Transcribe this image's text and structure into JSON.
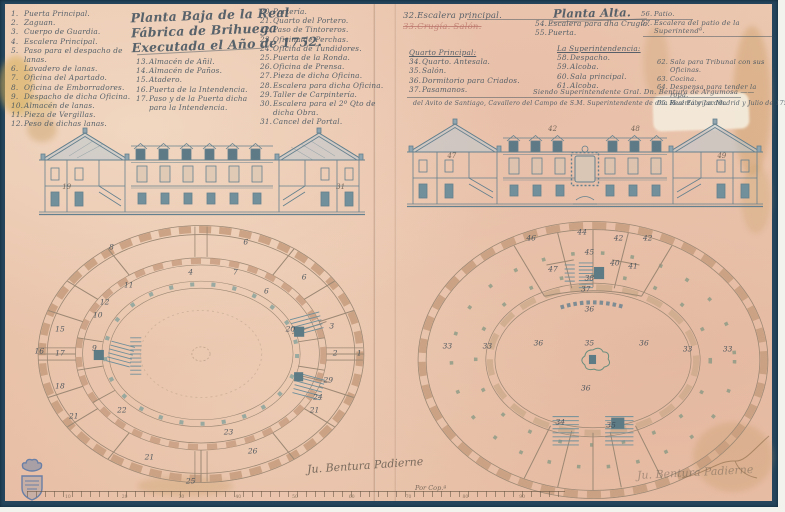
{
  "colors": {
    "paper": "#e9c4ac",
    "frame": "#24455c",
    "ink": "#42525e",
    "wall": "#c89e80",
    "stamp_blue": "#4a6fa5",
    "roof": "#9db3bd",
    "pillar_teal": "#7e9f9b"
  },
  "doc": {
    "left_title": {
      "l1": "Planta Baja de la Real",
      "l2": "Fábrica de Brihuega",
      "l3": "Executada el Año de 1752."
    },
    "right_title": "Planta Alta."
  },
  "legend_left": {
    "col1": [
      {
        "n": "1.",
        "t": "Puerta Principal."
      },
      {
        "n": "2.",
        "t": "Zaguan."
      },
      {
        "n": "3.",
        "t": "Cuerpo de Guardia."
      },
      {
        "n": "4.",
        "t": "Escalera Principal."
      },
      {
        "n": "5.",
        "t": "Paso para el despacho de lanas."
      },
      {
        "n": "6.",
        "t": "Lavadero de lanas."
      },
      {
        "n": "7.",
        "t": "Oficina del Apartado."
      },
      {
        "n": "8.",
        "t": "Oficina de Emborradores."
      },
      {
        "n": "9.",
        "t": "Despacho de dicha Oficina."
      },
      {
        "n": "10.",
        "t": "Almacén de lanas."
      },
      {
        "n": "11.",
        "t": "Pieza de Vergillas."
      },
      {
        "n": "12.",
        "t": "Peso de dichas lanas."
      }
    ],
    "col2": [
      {
        "n": "13.",
        "t": "Almacén de Añil."
      },
      {
        "n": "14.",
        "t": "Almacén de Paños."
      },
      {
        "n": "15.",
        "t": "Atadero."
      },
      {
        "n": "16.",
        "t": "Puerta de la Intendencia."
      },
      {
        "n": "17.",
        "t": "Paso y de la Puerta dicha"
      },
      {
        "n": "",
        "t": "para la Intendencia."
      }
    ],
    "col3": [
      {
        "n": "20.",
        "t": "Portería."
      },
      {
        "n": "21.",
        "t": "Quarto del Portero."
      },
      {
        "n": "22.",
        "t": "Paso de Tintoreros."
      },
      {
        "n": "23.",
        "t": "Oficina de Perchas."
      },
      {
        "n": "24.",
        "t": "Oficina de Tundidores."
      },
      {
        "n": "25.",
        "t": "Puerta de la Ronda."
      },
      {
        "n": "26.",
        "t": "Oficina de Prensa."
      },
      {
        "n": "27.",
        "t": "Pieza de dicha Oficina."
      },
      {
        "n": "28.",
        "t": "Escalera para dicha Oficina."
      },
      {
        "n": "29.",
        "t": "Taller de Carpintería."
      },
      {
        "n": "30.",
        "t": "Escalera para el 2º Qto de dicha Obra."
      },
      {
        "n": "31.",
        "t": "Cancel del Portal."
      }
    ]
  },
  "legend_right": {
    "a1": {
      "n": "32.",
      "t": "Escalera principal."
    },
    "a2": {
      "n": "33.",
      "t": "Crugía. Salón."
    },
    "quarto_header": "Quarto Principal:",
    "quarto": [
      {
        "n": "34.",
        "t": "Quarto. Antesala."
      },
      {
        "n": "35.",
        "t": "Salón."
      },
      {
        "n": "36.",
        "t": "Dormitorio para Criados."
      },
      {
        "n": "37.",
        "t": "Pasamanos."
      }
    ],
    "pre": [
      {
        "n": "54.",
        "t": "Escalera para dha Crugía."
      },
      {
        "n": "55.",
        "t": "Puerta."
      }
    ],
    "super_header": "La Superintendencia:",
    "super": [
      {
        "n": "58.",
        "t": "Despacho."
      },
      {
        "n": "59.",
        "t": "Alcoba."
      },
      {
        "n": "60.",
        "t": "Sala principal."
      },
      {
        "n": "61.",
        "t": "Alcoba."
      }
    ],
    "far_right": [
      {
        "n": "62.",
        "t": "Sala para Tribunal con sus Oficinas."
      },
      {
        "n": "63.",
        "t": "Cocina."
      },
      {
        "n": "64.",
        "t": "Despensa para tender la ropa."
      },
      {
        "n": "65.",
        "t": "Huerta y Jardín."
      }
    ],
    "top_right": [
      {
        "n": "56.",
        "t": "Patio."
      },
      {
        "n": "57.",
        "t": "Escalera del patio de la Superintendª."
      }
    ]
  },
  "notes": {
    "line1": "Siendo Superintendente Gral. Dn. Bentura de Argumosa ——",
    "line2": "del Avito de Santiago, Cavallero del Campo de S.M. Superintendente de dha Real Fábrica. Madrid y Julio de 1752."
  },
  "signatures": {
    "left": "Ju. Bentura Padierne",
    "left_sub": "Por Cop.ª",
    "right": "Ju. Bentura Padierne"
  },
  "elevations": {
    "left": {
      "labels": [
        {
          "t": "19",
          "x": 9,
          "y": 66
        },
        {
          "t": "31",
          "x": 92,
          "y": 66
        }
      ]
    },
    "right": {
      "labels": [
        {
          "t": "47",
          "x": 13,
          "y": 42
        },
        {
          "t": "42",
          "x": 41,
          "y": 14
        },
        {
          "t": "48",
          "x": 64,
          "y": 14
        },
        {
          "t": "49",
          "x": 88,
          "y": 42
        }
      ]
    }
  },
  "plans": {
    "left": {
      "labels": [
        {
          "t": "8",
          "x": 24,
          "y": 10
        },
        {
          "t": "6",
          "x": 63,
          "y": 8
        },
        {
          "t": "4",
          "x": 47,
          "y": 19
        },
        {
          "t": "7",
          "x": 60,
          "y": 19
        },
        {
          "t": "6",
          "x": 69,
          "y": 26
        },
        {
          "t": "6",
          "x": 80,
          "y": 21
        },
        {
          "t": "11",
          "x": 29,
          "y": 24
        },
        {
          "t": "12",
          "x": 22,
          "y": 30
        },
        {
          "t": "10",
          "x": 20,
          "y": 35
        },
        {
          "t": "15",
          "x": 9,
          "y": 40
        },
        {
          "t": "16",
          "x": 3,
          "y": 48
        },
        {
          "t": "17",
          "x": 9,
          "y": 49
        },
        {
          "t": "9",
          "x": 19,
          "y": 47
        },
        {
          "t": "18",
          "x": 9,
          "y": 61
        },
        {
          "t": "3",
          "x": 88,
          "y": 39
        },
        {
          "t": "2",
          "x": 89,
          "y": 49
        },
        {
          "t": "1",
          "x": 96,
          "y": 49
        },
        {
          "t": "20",
          "x": 76,
          "y": 40
        },
        {
          "t": "29",
          "x": 87,
          "y": 59
        },
        {
          "t": "24",
          "x": 84,
          "y": 65
        },
        {
          "t": "21",
          "x": 83,
          "y": 70
        },
        {
          "t": "22",
          "x": 27,
          "y": 70
        },
        {
          "t": "21",
          "x": 13,
          "y": 72
        },
        {
          "t": "23",
          "x": 58,
          "y": 78
        },
        {
          "t": "26",
          "x": 65,
          "y": 85
        },
        {
          "t": "21",
          "x": 35,
          "y": 87
        },
        {
          "t": "25",
          "x": 47,
          "y": 96
        }
      ]
    },
    "right": {
      "labels": [
        {
          "t": "46",
          "x": 33,
          "y": 7
        },
        {
          "t": "44",
          "x": 47,
          "y": 5
        },
        {
          "t": "42",
          "x": 57,
          "y": 7
        },
        {
          "t": "42",
          "x": 65,
          "y": 7
        },
        {
          "t": "47",
          "x": 39,
          "y": 18
        },
        {
          "t": "45",
          "x": 49,
          "y": 12
        },
        {
          "t": "40",
          "x": 56,
          "y": 16
        },
        {
          "t": "41",
          "x": 61,
          "y": 17
        },
        {
          "t": "38",
          "x": 49,
          "y": 21
        },
        {
          "t": "37",
          "x": 48,
          "y": 25
        },
        {
          "t": "36",
          "x": 49,
          "y": 32
        },
        {
          "t": "33",
          "x": 10,
          "y": 45
        },
        {
          "t": "33",
          "x": 21,
          "y": 45
        },
        {
          "t": "36",
          "x": 35,
          "y": 44
        },
        {
          "t": "35",
          "x": 49,
          "y": 44
        },
        {
          "t": "36",
          "x": 64,
          "y": 44
        },
        {
          "t": "33",
          "x": 76,
          "y": 46
        },
        {
          "t": "33",
          "x": 87,
          "y": 46
        },
        {
          "t": "36",
          "x": 48,
          "y": 60
        },
        {
          "t": "34",
          "x": 41,
          "y": 72
        },
        {
          "t": "35",
          "x": 55,
          "y": 73
        }
      ]
    }
  },
  "scale_bar": {
    "ticks": [
      {
        "t": "10"
      },
      {
        "t": "20"
      },
      {
        "t": "30"
      },
      {
        "t": "40"
      },
      {
        "t": "50"
      },
      {
        "t": "60"
      },
      {
        "t": "70"
      },
      {
        "t": "80"
      },
      {
        "t": "90"
      }
    ]
  }
}
